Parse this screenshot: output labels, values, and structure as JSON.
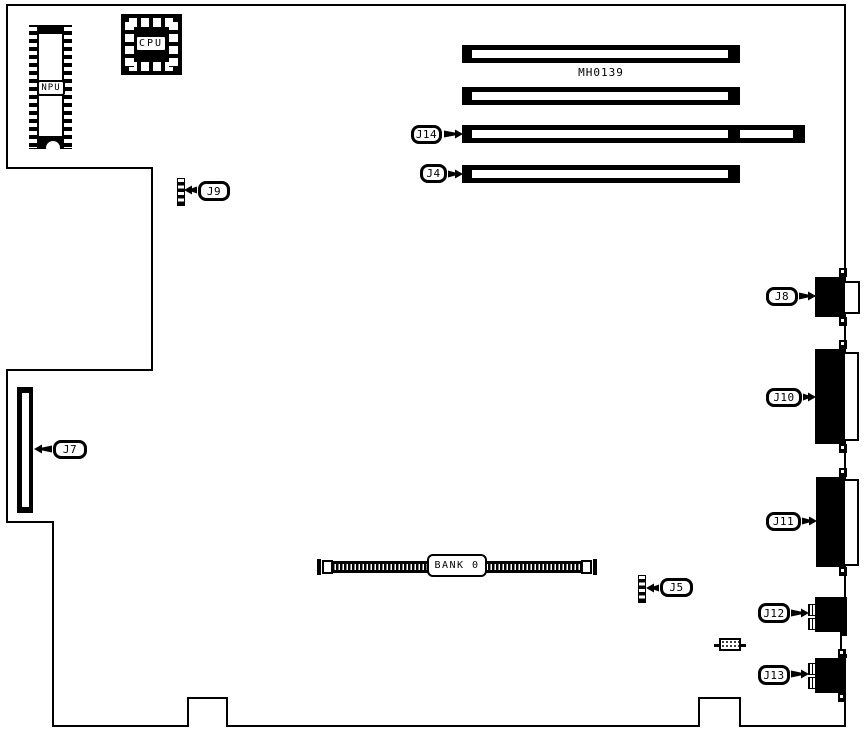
{
  "board": {
    "part_number": "MH0139",
    "chips": {
      "cpu_label": "CPU",
      "npu_label": "NPU"
    },
    "memory": {
      "bank_label": "BANK 0"
    },
    "callouts": {
      "j4": "J4",
      "j5": "J5",
      "j7": "J7",
      "j8": "J8",
      "j9": "J9",
      "j10": "J10",
      "j11": "J11",
      "j12": "J12",
      "j13": "J13",
      "j14": "J14"
    }
  }
}
